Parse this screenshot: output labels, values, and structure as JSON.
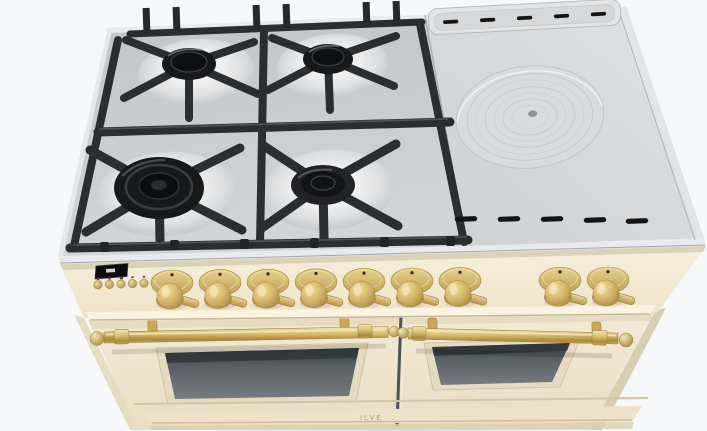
{
  "scene": {
    "description": "Product render of a freestanding 100cm dual-fuel range cooker seen from above-front",
    "background_color": "#f7f8fa"
  },
  "appliance": {
    "brand_logo": "ILVE",
    "finish": "cream enamel with brass trim",
    "cooktop": {
      "left_section": {
        "surface": "stainless steel with black cast-iron grates",
        "burner_count": 4,
        "burners": [
          "back-left burner",
          "back-right burner",
          "front-left triple-ring wok burner",
          "front-right burner"
        ],
        "grate_color": "#2b2e31"
      },
      "right_section": {
        "surface": "solid griddle plate (coup de feu)",
        "simmer_plate": "round plate with concentric rings and center plug",
        "vent_rows": 2,
        "vents_per_row": 5
      }
    },
    "control_panel": {
      "display": {
        "kind": "digital clock display",
        "screen_color": "#0b0c0e"
      },
      "button_count": 5,
      "knob_count": 9,
      "knob_layout": "7 knobs left group, 2 knobs right group",
      "knob_color": "#d4b96a"
    },
    "ovens": {
      "door_count": 2,
      "window_count": 2,
      "handle_style": "brass towel-rail with ball finials"
    }
  },
  "palette": {
    "background": "#f7f8fa",
    "cream_body": "#f3ead6",
    "brass": "#d4b96a",
    "stainless_gas": "#c9cccf",
    "griddle_plate": "#d7d9db",
    "grate_black": "#2b2e31",
    "burner_black": "#141517",
    "oven_glass": "#5a6167"
  }
}
